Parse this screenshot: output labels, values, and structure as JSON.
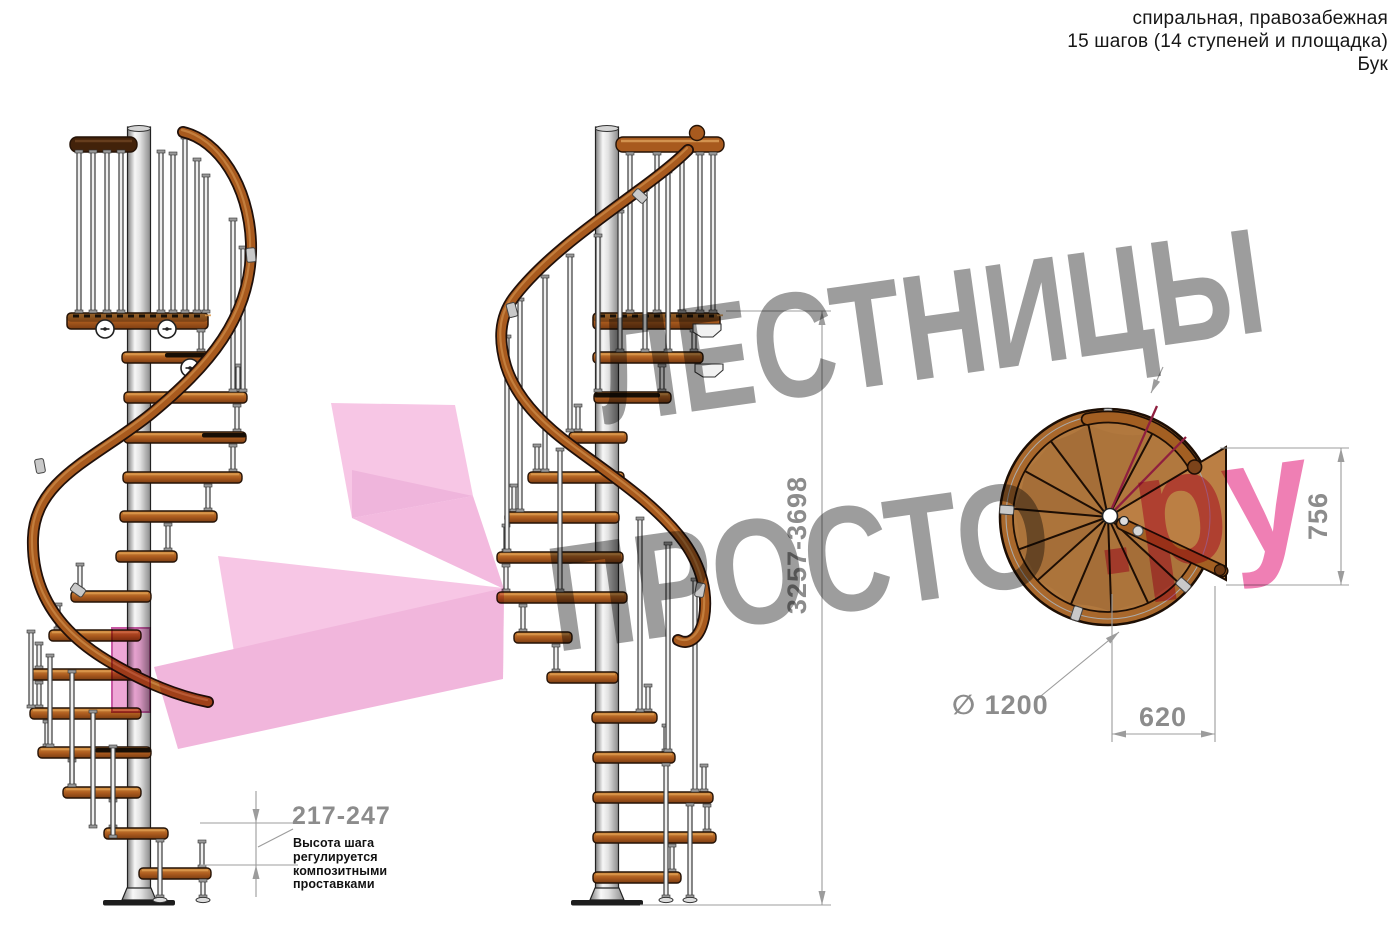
{
  "header": {
    "line1": "спиральная, правозабежная",
    "line2": "15 шагов (14 ступеней и площадка)",
    "line3": "Бук"
  },
  "watermark": {
    "line1": "ЛЕСТНИЦЫ",
    "line2": "ПРОСТО",
    "suffix": ".ру"
  },
  "dimensions": {
    "total_height": "3257-3698",
    "step_height": "217-247",
    "diameter_label": "∅ 1200",
    "landing_depth": "756",
    "landing_width": "620"
  },
  "annotation": {
    "step_note": "Высота шага\nрегулируется\nкомпозитными\nпроставками"
  },
  "colors": {
    "wood_light": "#d08c3f",
    "wood_mid": "#ae5d1f",
    "wood_dark": "#7c3d12",
    "outline": "#241206",
    "steel_light": "#f7f7f7",
    "steel_mid": "#cfcfcf",
    "steel_dark": "#828282",
    "rail": "#a85a1e",
    "plan_wood": "#b1783e",
    "landing_wood": "#bb7f44",
    "watermark_gray": "#9d9d9d",
    "watermark_pink": "#ef7fb4",
    "arrow_pink": "#f6c0e2",
    "arrow_pink_dark": "#eeadd9",
    "crimson": "#8f1f3f",
    "dim_gray": "#9c9c9c",
    "dim_text": "#8c8c8c"
  }
}
